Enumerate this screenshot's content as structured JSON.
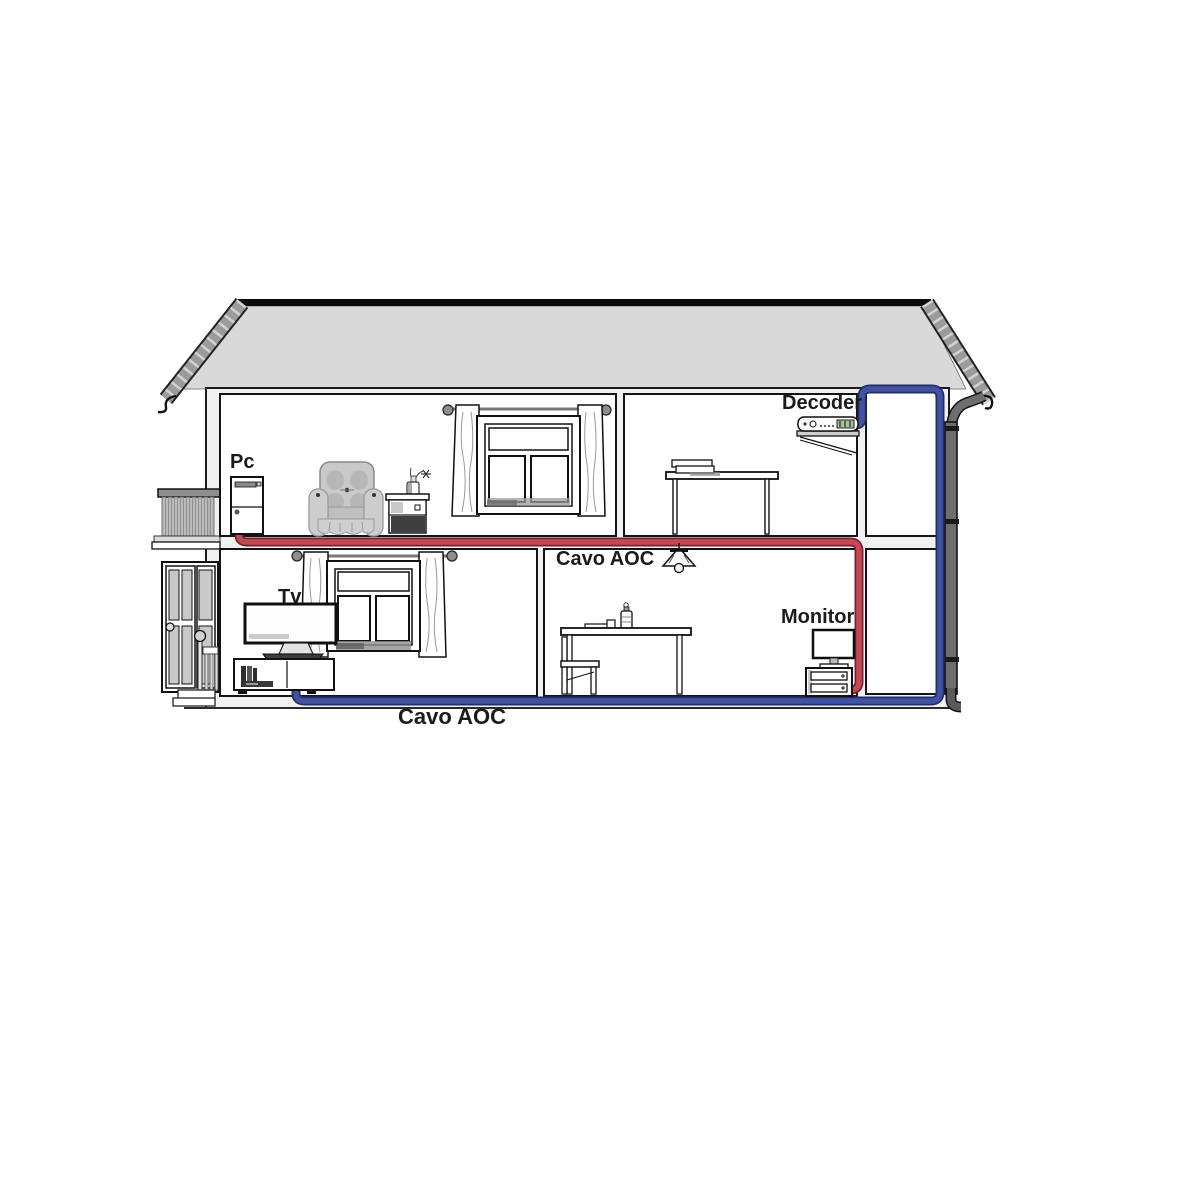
{
  "labels": {
    "pc": "Pc",
    "decoder": "Decoder",
    "tv": "Tv",
    "cavo_aoc_room": "Cavo AOC",
    "monitor": "Monitor",
    "cavo_aoc_bottom": "Cavo AOC"
  },
  "colors": {
    "cable_red": "#c24955",
    "cable_red_edge": "#77222f",
    "cable_blue": "#4252a3",
    "cable_blue_edge": "#242e66",
    "roof_fill": "#d9d9d9",
    "rake_gray": "#9b9b9b",
    "downspout_gray": "#6e6e6e",
    "slab_gray": "#f1f1f1",
    "line_black": "#141414"
  },
  "connections": [
    {
      "cable": "red",
      "from": "Pc",
      "to": "Monitor",
      "label": "Cavo AOC"
    },
    {
      "cable": "blue",
      "from": "Decoder",
      "to": "Tv",
      "label": "Cavo AOC"
    }
  ]
}
